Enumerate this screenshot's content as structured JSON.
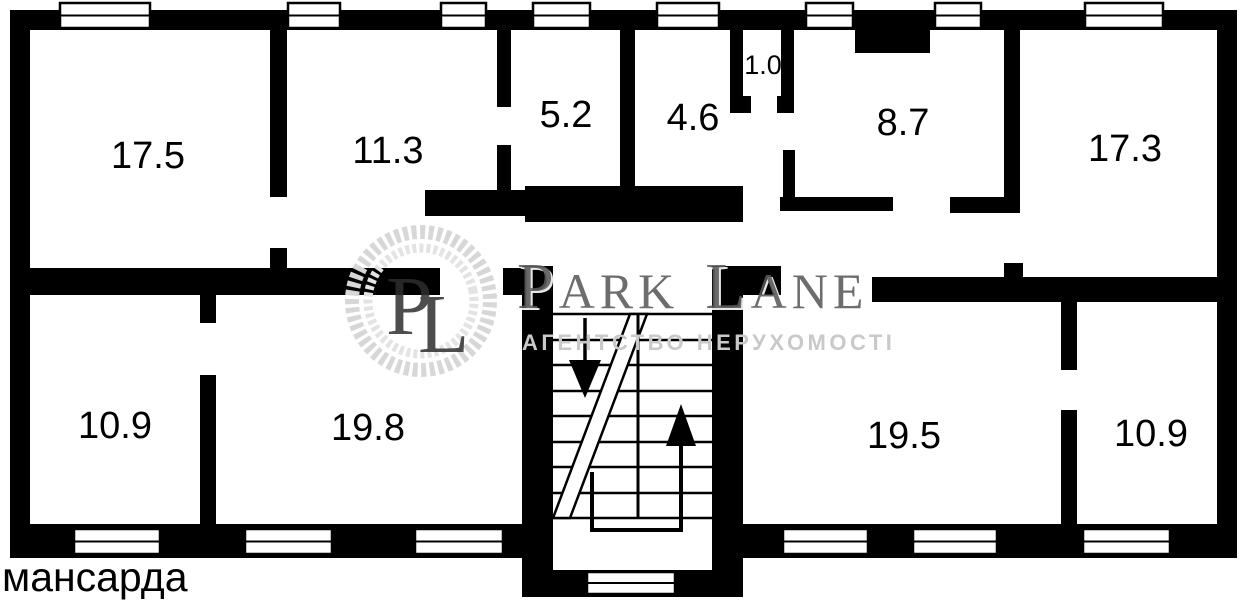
{
  "page": {
    "background": "#ffffff"
  },
  "colors": {
    "walls": "#000000",
    "window_frame": "#000000",
    "window_pane": "#ffffff",
    "stair_lines": "#000000",
    "label": "#000000",
    "wreath_outer": "#d7d7d7",
    "wreath_inner": "#e3e3e3",
    "monogram": "#2e2e2e",
    "brand": "#5a5a5a",
    "brand_highlight": "#ffffff",
    "tagline": "#c9c9c9"
  },
  "plan": {
    "floor_label": "мансарда",
    "rooms": [
      {
        "area": "17.5"
      },
      {
        "area": "11.3"
      },
      {
        "area": "5.2"
      },
      {
        "area": "4.6"
      },
      {
        "area": "1.0"
      },
      {
        "area": "8.7"
      },
      {
        "area": "17.3"
      },
      {
        "area": "10.9"
      },
      {
        "area": "19.8"
      },
      {
        "area": "19.5"
      },
      {
        "area": "10.9"
      }
    ]
  },
  "watermark": {
    "monogram_p": "P",
    "monogram_l": "L",
    "brand_word1_initial": "P",
    "brand_word1_rest": "ARK",
    "brand_word2_initial": "L",
    "brand_word2_rest": "ANE",
    "tagline": "АГЕНТСТВО НЕРУХОМОСТІ"
  }
}
